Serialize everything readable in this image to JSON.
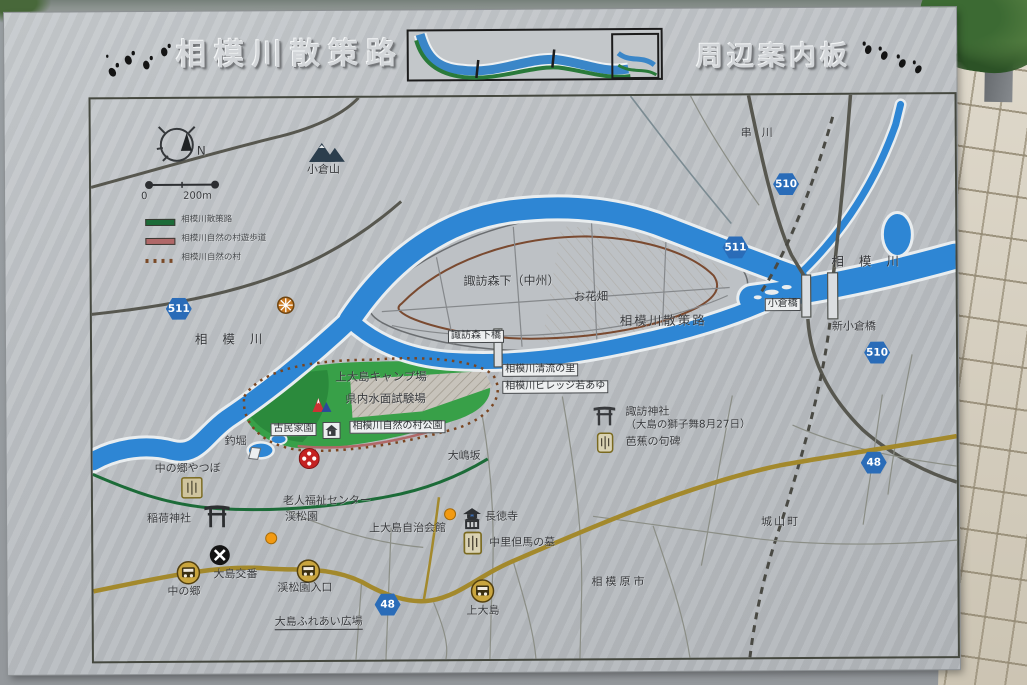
{
  "title": {
    "left": "相模川散策路",
    "right": "周辺案内板"
  },
  "legend": {
    "compass_north": "N",
    "scale_start": "0",
    "scale_end": "200m",
    "items": [
      {
        "label": "相模川散策路",
        "color": "#1c6b38",
        "style": "solid"
      },
      {
        "label": "相模川自然の村遊歩道",
        "color": "#b06868",
        "style": "solid"
      },
      {
        "label": "相模川自然の村",
        "color": "#7a4a28",
        "style": "dotted"
      }
    ]
  },
  "map": {
    "labels": {
      "ogurayama": "小倉山",
      "kushikawa": "串川",
      "sagamigawa_left": "相模川",
      "sagamigawa_right": "相模川",
      "suwamorishita": "諏訪森下（中州）",
      "ohanabatake": "お花畑",
      "sansakuro": "相模川散策路",
      "suwamorishitabashi": "諏訪森下橋",
      "ogurabashi": "小倉橋",
      "shin_ogurabashi": "新小倉橋",
      "camp": "上大島キャンプ場",
      "shikenjo": "県内水面試験場",
      "seiryu_no_sato": "相模川清流の里",
      "village_wakaayu": "相模川ビレッジ若あゆ",
      "shizen_no_mura_koen": "相模川自然の村公園",
      "kominkaen": "古民家園",
      "oshimazaka": "大嶋坂",
      "suwa_jinja": "諏訪神社",
      "suwa_jinja_note": "（大島の獅子舞8月27日）",
      "basho_kuhi": "芭蕉の句碑",
      "tsuribori": "釣堀",
      "nakanogo_yatsubo": "中の郷やつぼ",
      "inari_jinja": "稲荷神社",
      "rojin_center": "老人福祉センター",
      "keishoen": "渓松園",
      "jichikaikan": "上大島自治会館",
      "chotokuji": "長徳寺",
      "nakazato_grave": "中里但馬の墓",
      "nakanogo": "中の郷",
      "oshima_koban": "大島交番",
      "keishoen_iriguchi": "渓松園入口",
      "oshima_fureai": "大島ふれあい広場",
      "kamioshima": "上大島",
      "sagamihara_shi": "相模原市",
      "shiroyama_machi": "城山町"
    },
    "badges": {
      "r510_top": "510",
      "r511_top": "511",
      "r511_left": "511",
      "r510_right": "510",
      "r48_right": "48",
      "r48_bottom": "48"
    }
  },
  "colors": {
    "river_blue": "#2e86d4",
    "walkway_green": "#1c6b38",
    "village_path_red": "#b06868",
    "village_boundary_brown": "#7a4a28",
    "route_badge_blue": "#2a6cb8",
    "main_road_gold": "#a3892c"
  }
}
